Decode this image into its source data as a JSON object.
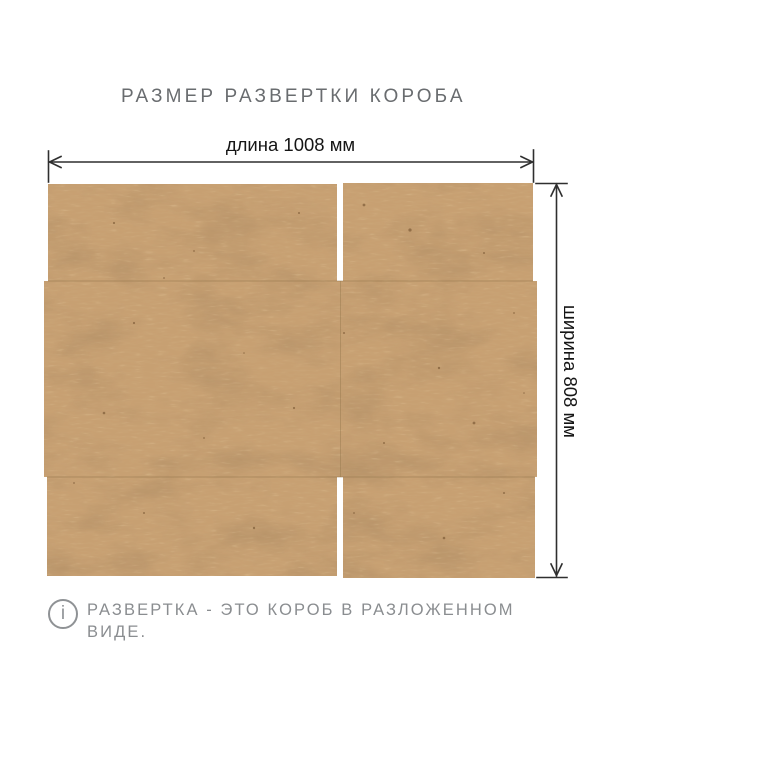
{
  "title": "РАЗМЕР РАЗВЕРТКИ КОРОБА",
  "dimensions": {
    "length_label": "длина 1008 мм",
    "length_value_mm": 1008,
    "width_label": "ширина 808 мм",
    "width_value_mm": 808
  },
  "figure": {
    "subject": "unfolded-cardboard-box-development",
    "panels": [
      "top-left-flap",
      "top-right-flap",
      "middle-panel",
      "bottom-left-flap",
      "bottom-right-flap"
    ],
    "colors": {
      "cardboard_base": "#c7a072",
      "cardboard_fiber_light": "#e6cba2",
      "cardboard_speckle_dark": "#6b4a28",
      "fold_line": "#8f7248",
      "dimension_line": "#2f2f2f",
      "title_text": "#696c6f",
      "note_text": "#8a8d90",
      "background": "#ffffff"
    }
  },
  "note": {
    "icon_glyph": "i",
    "text": "РАЗВЕРТКА - ЭТО КОРОБ В РАЗЛОЖЕННОМ ВИДЕ."
  }
}
